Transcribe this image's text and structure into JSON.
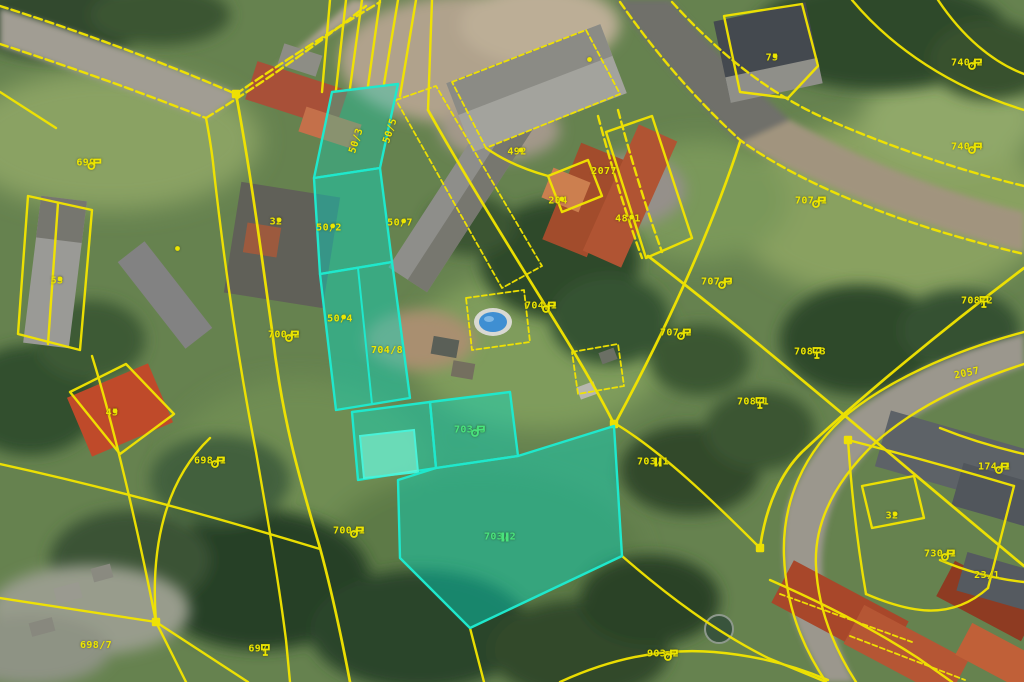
{
  "map": {
    "kind": "cadastral-parcel-overlay-on-aerial-photo",
    "colors": {
      "parcel_line": "#f2e400",
      "highlight_line": "#1fe8cc",
      "highlight_fill": "rgba(0,224,200,0.42)",
      "label_yellow": "#ede600",
      "label_green": "#49e37c"
    },
    "highlighted_parcels": [
      "50/2",
      "50/4",
      "704/8",
      "703/3",
      "703/2"
    ],
    "labels": [
      {
        "text": "699",
        "x": 86,
        "y": 163,
        "symbol": "meadow"
      },
      {
        "text": "53",
        "x": 57,
        "y": 281,
        "symbol": "dot"
      },
      {
        "text": "32",
        "x": 276,
        "y": 222,
        "symbol": "dot"
      },
      {
        "text": "45",
        "x": 112,
        "y": 413,
        "symbol": "dot"
      },
      {
        "text": "698/1",
        "x": 210,
        "y": 461,
        "symbol": "meadow"
      },
      {
        "text": "700/2",
        "x": 284,
        "y": 335,
        "symbol": "meadow"
      },
      {
        "text": "700/1",
        "x": 349,
        "y": 531,
        "symbol": "meadow"
      },
      {
        "text": "697",
        "x": 258,
        "y": 649,
        "symbol": "tree"
      },
      {
        "text": "698/7",
        "x": 96,
        "y": 646
      },
      {
        "text": "50/2",
        "x": 329,
        "y": 228,
        "symbol": "dot"
      },
      {
        "text": "50/7",
        "x": 400,
        "y": 223,
        "symbol": "dot"
      },
      {
        "text": "50/4",
        "x": 340,
        "y": 319,
        "symbol": "dot"
      },
      {
        "text": "704/8",
        "x": 387,
        "y": 351
      },
      {
        "text": "50/3",
        "x": 357,
        "y": 141,
        "rotation": -72
      },
      {
        "text": "50/5",
        "x": 391,
        "y": 131,
        "rotation": -72
      },
      {
        "text": "492",
        "x": 517,
        "y": 152,
        "symbol": "dot"
      },
      {
        "text": "2077",
        "x": 604,
        "y": 172
      },
      {
        "text": "204",
        "x": 558,
        "y": 201,
        "symbol": "dot"
      },
      {
        "text": "48/1",
        "x": 628,
        "y": 219,
        "symbol": "dot"
      },
      {
        "text": "",
        "x": 586,
        "y": 56,
        "symbol": "dot"
      },
      {
        "text": "",
        "x": 174,
        "y": 245,
        "symbol": "dot"
      },
      {
        "text": "75",
        "x": 772,
        "y": 58,
        "symbol": "dot"
      },
      {
        "text": "740/2",
        "x": 967,
        "y": 63,
        "symbol": "meadow"
      },
      {
        "text": "740/4",
        "x": 967,
        "y": 147,
        "symbol": "meadow"
      },
      {
        "text": "707/1",
        "x": 811,
        "y": 201,
        "symbol": "meadow"
      },
      {
        "text": "707/3",
        "x": 717,
        "y": 282,
        "symbol": "meadow"
      },
      {
        "text": "707/2",
        "x": 676,
        "y": 333,
        "symbol": "meadow"
      },
      {
        "text": "704/1",
        "x": 541,
        "y": 306,
        "symbol": "meadow"
      },
      {
        "text": "708/2",
        "x": 977,
        "y": 301,
        "symbol": "tree"
      },
      {
        "text": "708/3",
        "x": 810,
        "y": 352,
        "symbol": "tree"
      },
      {
        "text": "708/1",
        "x": 753,
        "y": 402,
        "symbol": "tree"
      },
      {
        "text": "2057",
        "x": 967,
        "y": 374,
        "rotation": -12
      },
      {
        "text": "703/3",
        "x": 470,
        "y": 430,
        "symbol": "meadow",
        "c": "g"
      },
      {
        "text": "703/2",
        "x": 500,
        "y": 537,
        "symbol": "bars",
        "c": "g"
      },
      {
        "text": "703/1",
        "x": 653,
        "y": 462,
        "symbol": "bars"
      },
      {
        "text": "174/1",
        "x": 994,
        "y": 467,
        "symbol": "meadow"
      },
      {
        "text": "32",
        "x": 892,
        "y": 516,
        "symbol": "dot"
      },
      {
        "text": "730/1",
        "x": 940,
        "y": 554,
        "symbol": "meadow"
      },
      {
        "text": "23/1",
        "x": 987,
        "y": 576
      },
      {
        "text": "903/2",
        "x": 663,
        "y": 654,
        "symbol": "meadow"
      }
    ]
  }
}
